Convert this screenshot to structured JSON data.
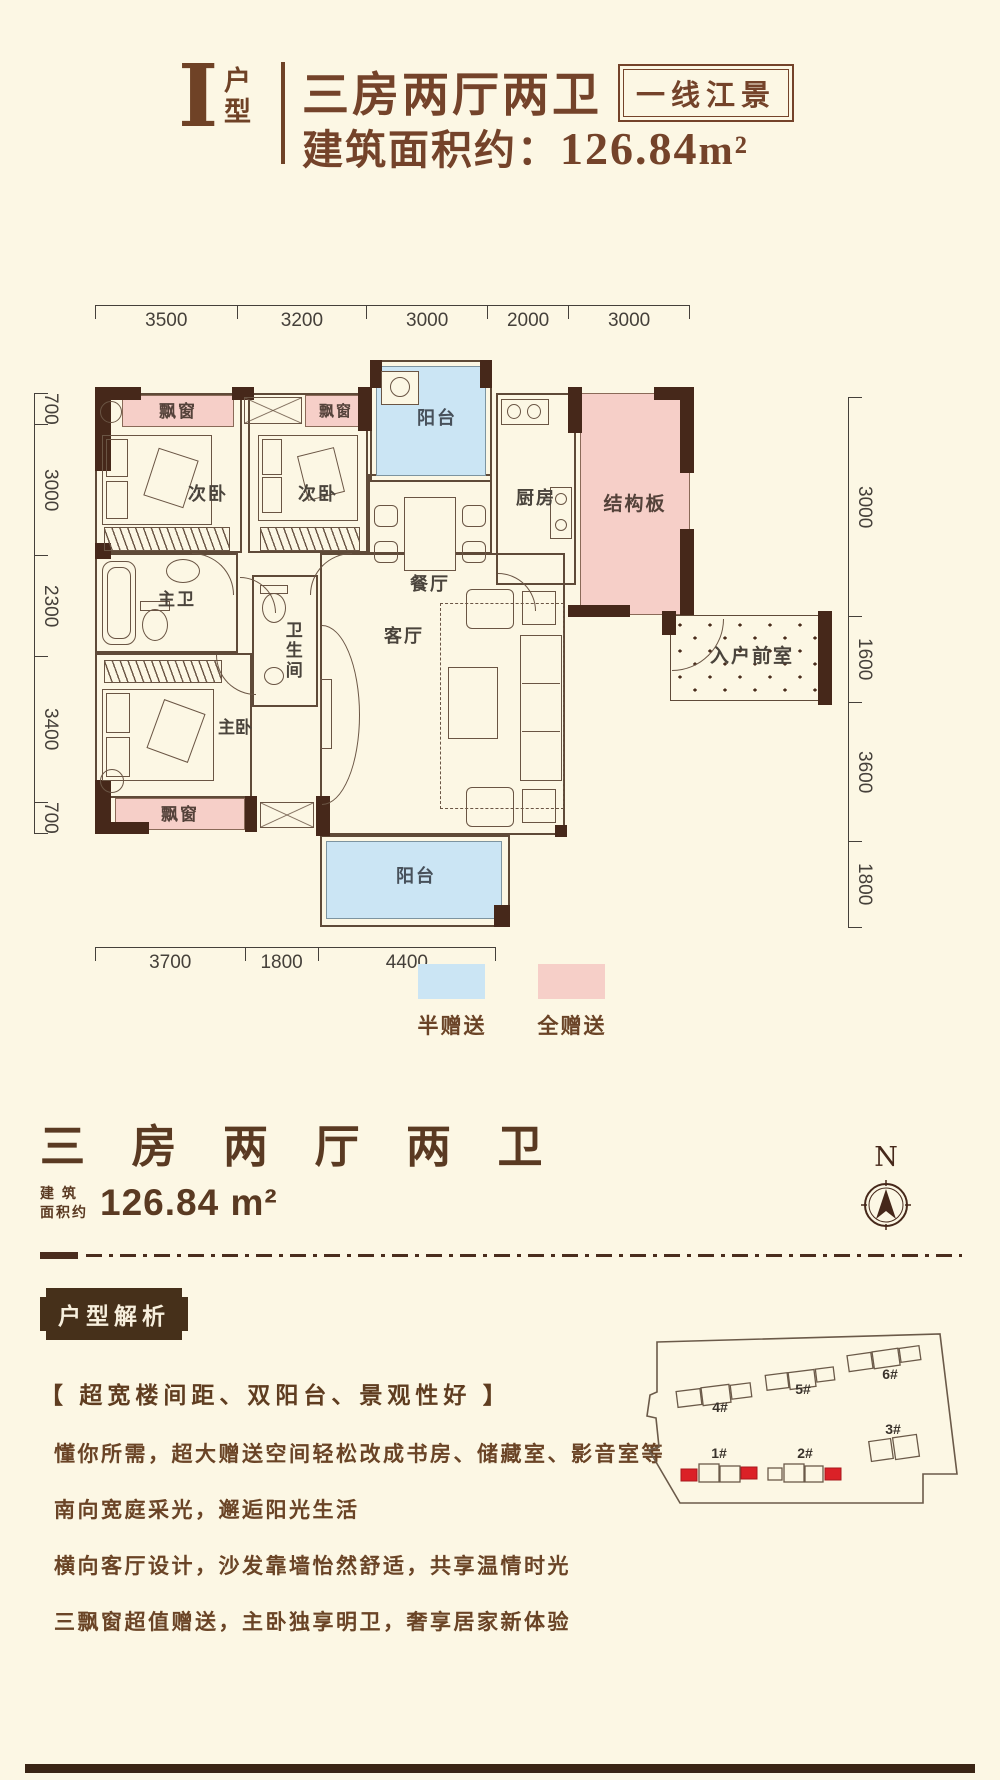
{
  "colors": {
    "background": "#fcf7e4",
    "title_brown": "#74432a",
    "wall_dark": "#46281a",
    "gift_full_pink": "#f6cfc8",
    "gift_half_blue": "#cbe5f4",
    "highlight_red": "#db2127"
  },
  "header": {
    "type_letter": "I",
    "type_label": "户型",
    "title": "三房两厅两卫",
    "badge": "一线江景",
    "area_prefix": "建筑面积约：",
    "area_value": "126.84",
    "area_unit": "m²"
  },
  "plan": {
    "dims_top": [
      "3500",
      "3200",
      "3000",
      "2000",
      "3000"
    ],
    "dims_left": [
      "700",
      "3000",
      "2300",
      "3400",
      "700"
    ],
    "dims_right": [
      "3000",
      "1600",
      "3600",
      "1800"
    ],
    "dims_bottom": [
      "3700",
      "1800",
      "4400"
    ],
    "rooms": {
      "bedroom2": "次卧",
      "bay_window": "飘窗",
      "balcony": "阳台",
      "dining": "餐厅",
      "kitchen": "厨房",
      "structural_slab": "结构板",
      "entry_foyer": "入户前室",
      "master_bath": "主卫",
      "bathroom": "卫生间",
      "living": "客厅",
      "master_bedroom": "主卧"
    }
  },
  "legend": {
    "half": "半赠送",
    "full": "全赠送"
  },
  "summary": {
    "title": "三 房 两 厅 两 卫",
    "area_label_line1": "建 筑",
    "area_label_line2": "面积约",
    "area_value": "126.84 m²",
    "compass": "N"
  },
  "analysis": {
    "badge": "户型解析",
    "headline": "【 超宽楼间距、双阳台、景观性好 】",
    "lines": [
      "懂你所需，超大赠送空间轻松改成书房、储藏室、影音室等",
      "南向宽庭采光，邂逅阳光生活",
      "横向客厅设计，沙发靠墙怡然舒适，共享温情时光",
      "三飘窗超值赠送，主卧独享明卫，奢享居家新体验"
    ]
  },
  "siteplan": {
    "buildings": [
      "4#",
      "5#",
      "6#",
      "3#",
      "1#",
      "2#"
    ]
  }
}
